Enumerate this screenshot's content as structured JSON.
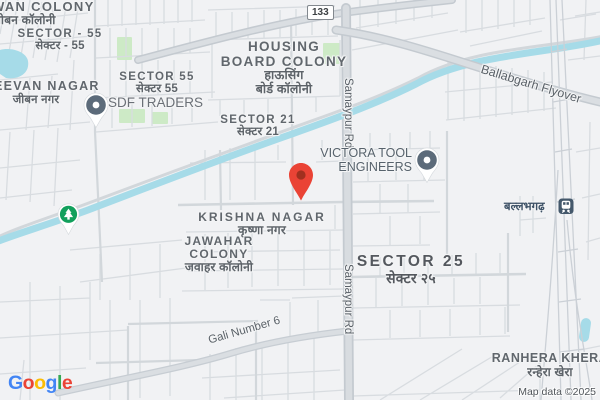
{
  "map": {
    "attribution": "Map data ©2025",
    "route_badge": {
      "number": "133"
    },
    "areas": {
      "wan_colony": {
        "en": "WAN COLONY",
        "hi": "जीबन कॉलोनी"
      },
      "sector_55_west": {
        "en": "SECTOR - 55",
        "hi": "सेक्टर - 55"
      },
      "eevan_nagar": {
        "en": "EEVAN NAGAR",
        "hi": "जीबन नगर"
      },
      "sector_55": {
        "en": "SECTOR 55",
        "hi": "सेक्टर 55"
      },
      "housing_board_colony": {
        "en1": "HOUSING",
        "en2": "BOARD COLONY",
        "hi1": "हाऊसिंग",
        "hi2": "बोर्ड कॉलोनी"
      },
      "sector_21": {
        "en": "SECTOR 21",
        "hi": "सेक्टर 21"
      },
      "krishna_nagar": {
        "en": "KRISHNA NAGAR",
        "hi": "कृष्णा नगर"
      },
      "jawahar_colony": {
        "en1": "JAWAHAR",
        "en2": "COLONY",
        "hi": "जवाहर कॉलोनी"
      },
      "sector_25": {
        "en": "SECTOR 25",
        "hi": "सेक्टर २५"
      },
      "ranhera_khera": {
        "en": "RANHERA KHERA",
        "hi": "रन्हेरा खेरा"
      }
    },
    "roads": {
      "samaypur_rd_north": "Samaypur Rd",
      "samaypur_rd_south": "Samaypur Rd",
      "ballabgarh_flyover": "Ballabgarh Flyover",
      "gali_number_6": "Gali Number 6"
    },
    "pois": {
      "sdf_traders": {
        "name": "SDF TRADERS",
        "icon": "poi-pin"
      },
      "victora_tool": {
        "name1": "VICTORA TOOL",
        "name2": "ENGINEERS",
        "icon": "poi-pin"
      },
      "ballabhgarh_station": {
        "name": "बल्लभगढ़",
        "icon": "train-icon"
      },
      "park": {
        "icon": "tree-pin"
      },
      "destination": {
        "icon": "red-map-pin"
      }
    },
    "google_logo": {
      "letters": [
        "G",
        "o",
        "o",
        "g",
        "l",
        "e"
      ]
    },
    "colors": {
      "pin_red": "#EA4335",
      "pin_red_inner": "#A0301F",
      "park_green": "#12A05C",
      "poi_gray": "#5C6B7A",
      "water": "#A6DBE8",
      "park_fill": "#CDEAC6",
      "logo": [
        "#4285F4",
        "#EA4335",
        "#FBBC05",
        "#4285F4",
        "#34A853",
        "#EA4335"
      ]
    }
  }
}
